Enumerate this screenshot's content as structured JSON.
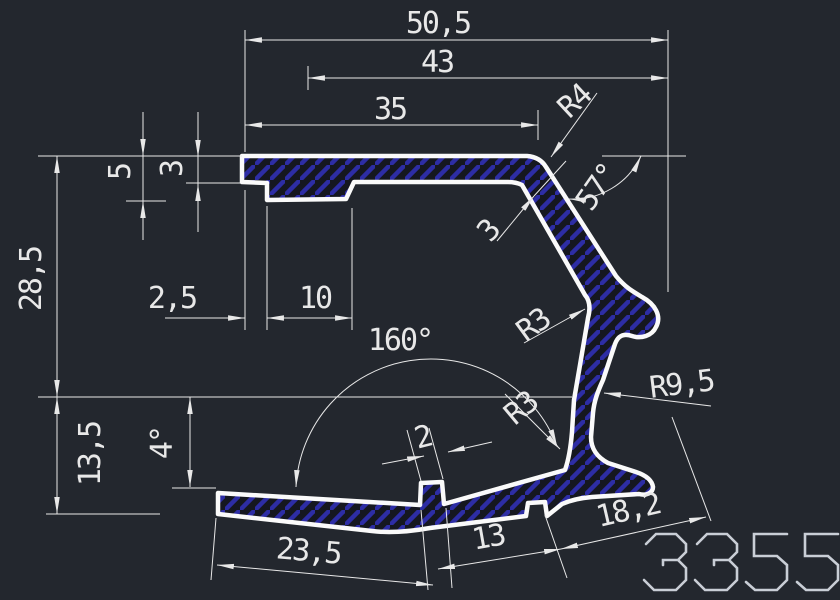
{
  "drawing": {
    "part_number": "3355",
    "colors": {
      "bg": "#23272e",
      "line": "#fafafa",
      "dim": "#e8e8e8",
      "hatch": "#2d2da5",
      "fill-dark": "#151720",
      "logo": "#c9ced6"
    },
    "dims": {
      "width_overall": "50,5",
      "width_43": "43",
      "width_35": "35",
      "radius_r4": "R4",
      "depth_5": "5",
      "thickness_3": "3",
      "angle_57": "57°",
      "height_28_5": "28,5",
      "width_2_5": "2,5",
      "width_10": "10",
      "angle_160": "160°",
      "wall_3": "3",
      "radius_r3_upper": "R3",
      "radius_r9_5": "R9,5",
      "radius_r3_lower": "R3",
      "height_13_5": "13,5",
      "angle_4": "4°",
      "width_2": "2",
      "width_23_5": "23,5",
      "width_13": "13",
      "width_18_2": "18,2"
    }
  }
}
